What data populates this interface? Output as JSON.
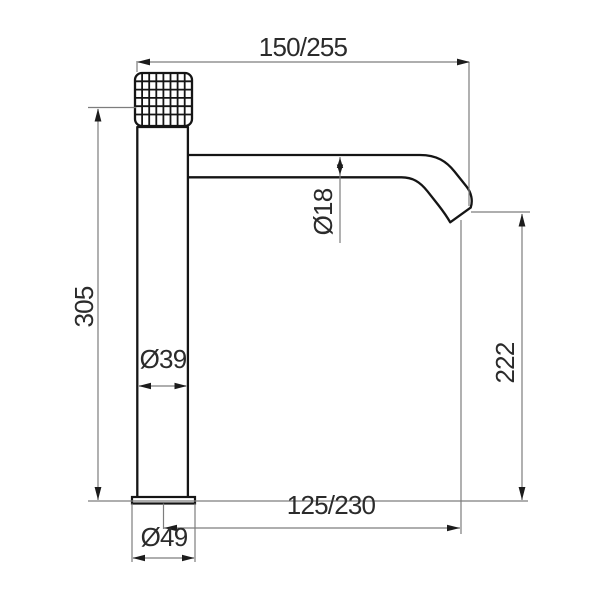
{
  "labels": {
    "top_width": "150/255",
    "total_height": "305",
    "spout_diameter": "Ø18",
    "body_diameter": "Ø39",
    "spout_height": "222",
    "spout_reach": "125/230",
    "base_diameter": "Ø49"
  },
  "colors": {
    "background": "#ffffff",
    "outline": "#151515",
    "dimension_line": "#7d7d7d",
    "arrow": "#1c1c1c",
    "text": "#2b2b2b"
  }
}
